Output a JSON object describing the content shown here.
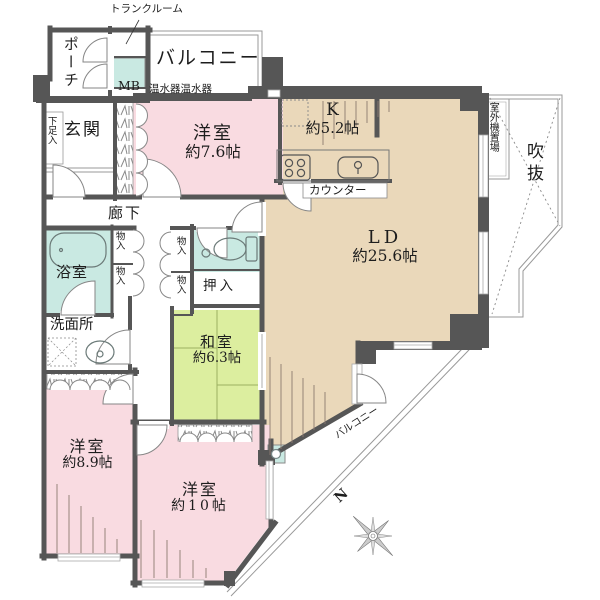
{
  "title": "マンション間取り図",
  "palette": {
    "room_pink": "#f9dbe1",
    "room_beige": "#ead8ba",
    "room_green": "#dcee9f",
    "room_teal": "#c9e9e2",
    "wall": "#565656",
    "text": "#1d1d1d"
  },
  "labels": {
    "trunk_room": "トランクルーム",
    "porch": "ポーチ",
    "meter_box": "MB",
    "balcony_top": "バルコニー",
    "water_heater": "温水器温水器",
    "shoe_cabinet": "下足入",
    "entrance": "玄関",
    "corridor": "廊下",
    "bathroom": "浴室",
    "closet": "物入",
    "oshiire": "押入",
    "washroom": "洗面所",
    "counter": "カウンター",
    "outdoor_unit": "室外機置場",
    "void": "吹抜",
    "balcony_bottom": "バルコニー",
    "compass_north": "N"
  },
  "rooms": {
    "bedroom1": {
      "name": "洋室",
      "size": "約7.6帖"
    },
    "kitchen": {
      "name": "K",
      "size": "約5.2帖"
    },
    "living_dining": {
      "name": "LD",
      "size": "約25.6帖"
    },
    "japanese_room": {
      "name": "和室",
      "size": "約6.3帖"
    },
    "bedroom2": {
      "name": "洋室",
      "size": "約8.9帖"
    },
    "bedroom3": {
      "name": "洋室",
      "size": "約10帖"
    }
  }
}
